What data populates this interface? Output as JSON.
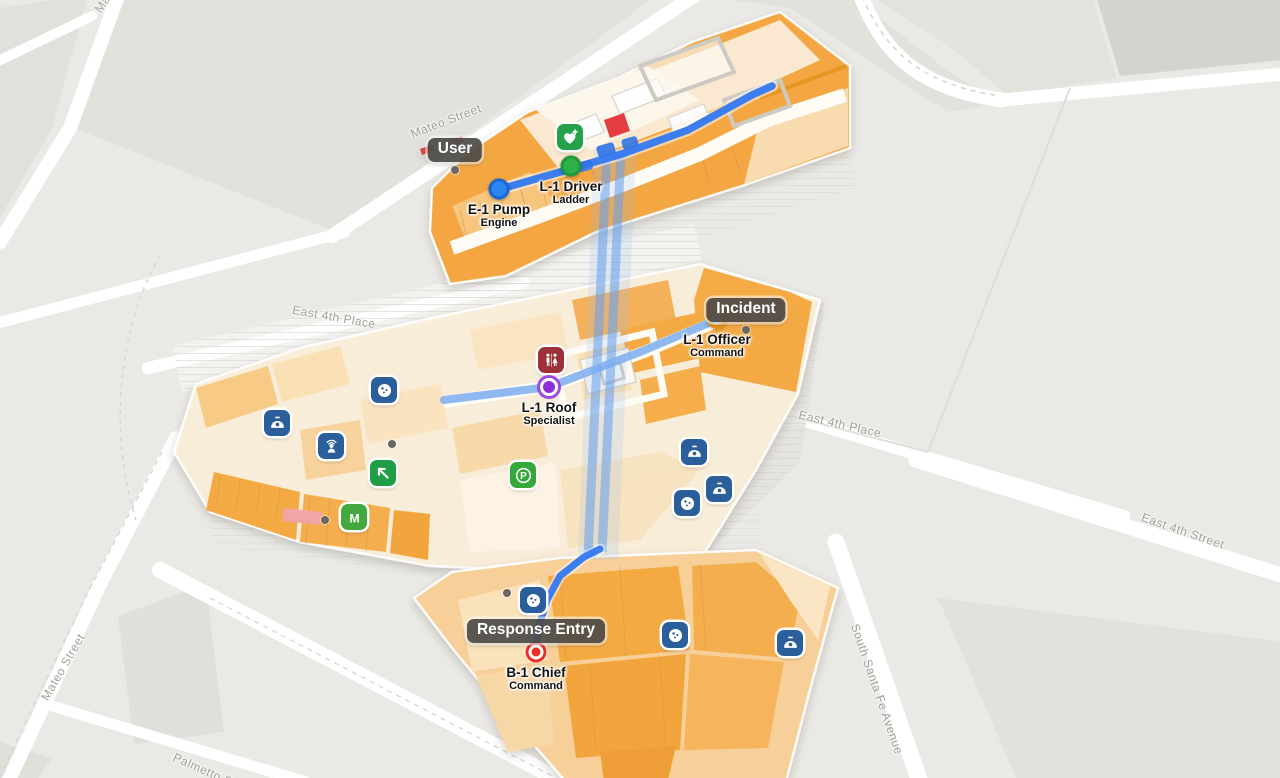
{
  "map": {
    "street_labels": [
      {
        "text": "Mateo Street",
        "x": 118,
        "y": -20,
        "rotate": -57
      },
      {
        "text": "Mateo Street",
        "x": 446,
        "y": 121,
        "rotate": -21
      },
      {
        "text": "Mateo Street",
        "x": 63,
        "y": 667,
        "rotate": -60
      },
      {
        "text": "East 4th Place",
        "x": 334,
        "y": 317,
        "rotate": 10
      },
      {
        "text": "East 4th Place",
        "x": 840,
        "y": 424,
        "rotate": 13
      },
      {
        "text": "East 4th Street",
        "x": 1183,
        "y": 531,
        "rotate": 19
      },
      {
        "text": "South Santa Fe Avenue",
        "x": 877,
        "y": 689,
        "rotate": 71
      },
      {
        "text": "Palmetto Street",
        "x": 215,
        "y": 775,
        "rotate": 24
      }
    ],
    "callouts": [
      {
        "id": "user",
        "label": "User",
        "x": 455,
        "y": 150
      },
      {
        "id": "incident",
        "label": "Incident",
        "x": 746,
        "y": 310
      },
      {
        "id": "response_entry",
        "label": "Response Entry",
        "x": 536,
        "y": 631
      }
    ],
    "units": [
      {
        "id": "e1_pump",
        "callsign": "E-1 Pump",
        "role": "Engine",
        "marker": "blue_dot",
        "x": 499,
        "y": 189
      },
      {
        "id": "l1_driver",
        "callsign": "L-1 Driver",
        "role": "Ladder",
        "marker": "green_dot",
        "x": 571,
        "y": 166
      },
      {
        "id": "l1_officer",
        "callsign": "L-1 Officer",
        "role": "Command",
        "marker": "orange_ring",
        "x": 717,
        "y": 319
      },
      {
        "id": "l1_roof",
        "callsign": "L-1 Roof",
        "role": "Specialist",
        "marker": "purple_dot",
        "x": 549,
        "y": 387
      },
      {
        "id": "b1_chief",
        "callsign": "B-1 Chief",
        "role": "Command",
        "marker": "red_target",
        "x": 536,
        "y": 652
      }
    ],
    "poi_icons": [
      {
        "type": "first-aid",
        "x": 570,
        "y": 137
      },
      {
        "type": "restroom",
        "x": 551,
        "y": 360
      },
      {
        "type": "parking",
        "x": 523,
        "y": 475
      },
      {
        "type": "metro",
        "x": 354,
        "y": 517
      },
      {
        "type": "exit-arrow",
        "x": 383,
        "y": 473
      },
      {
        "type": "karaoke",
        "x": 331,
        "y": 446
      },
      {
        "type": "dome",
        "x": 277,
        "y": 423
      },
      {
        "type": "dome",
        "x": 694,
        "y": 452
      },
      {
        "type": "dome",
        "x": 719,
        "y": 489
      },
      {
        "type": "dome",
        "x": 790,
        "y": 643
      },
      {
        "type": "cookie",
        "x": 384,
        "y": 390
      },
      {
        "type": "cookie",
        "x": 687,
        "y": 503
      },
      {
        "type": "cookie",
        "x": 533,
        "y": 600
      },
      {
        "type": "cookie",
        "x": 675,
        "y": 635
      }
    ],
    "unlabeled_dots": [
      {
        "x": 455,
        "y": 170
      },
      {
        "x": 746,
        "y": 330
      },
      {
        "x": 392,
        "y": 444
      },
      {
        "x": 325,
        "y": 520
      },
      {
        "x": 507,
        "y": 593
      }
    ],
    "poi_colors": {
      "first-aid": "#23a24b",
      "restroom": "#9d3038",
      "parking": "#35a83a",
      "metro": "#43a83d",
      "exit-arrow": "#1f9e45",
      "karaoke": "#2b5f9b",
      "dome": "#2b5f9b",
      "cookie": "#2b5f9b"
    },
    "theme_colors": {
      "route_blue": "#3c7ef0",
      "route_band": "rgba(100,158,236,0.55)",
      "building_orange": "#f4a43c",
      "callout_bg": "rgba(77,75,72,0.93)",
      "map_background": "#eae9e5",
      "street_white": "#ffffff",
      "incident_red_square": "#e5383b"
    }
  }
}
